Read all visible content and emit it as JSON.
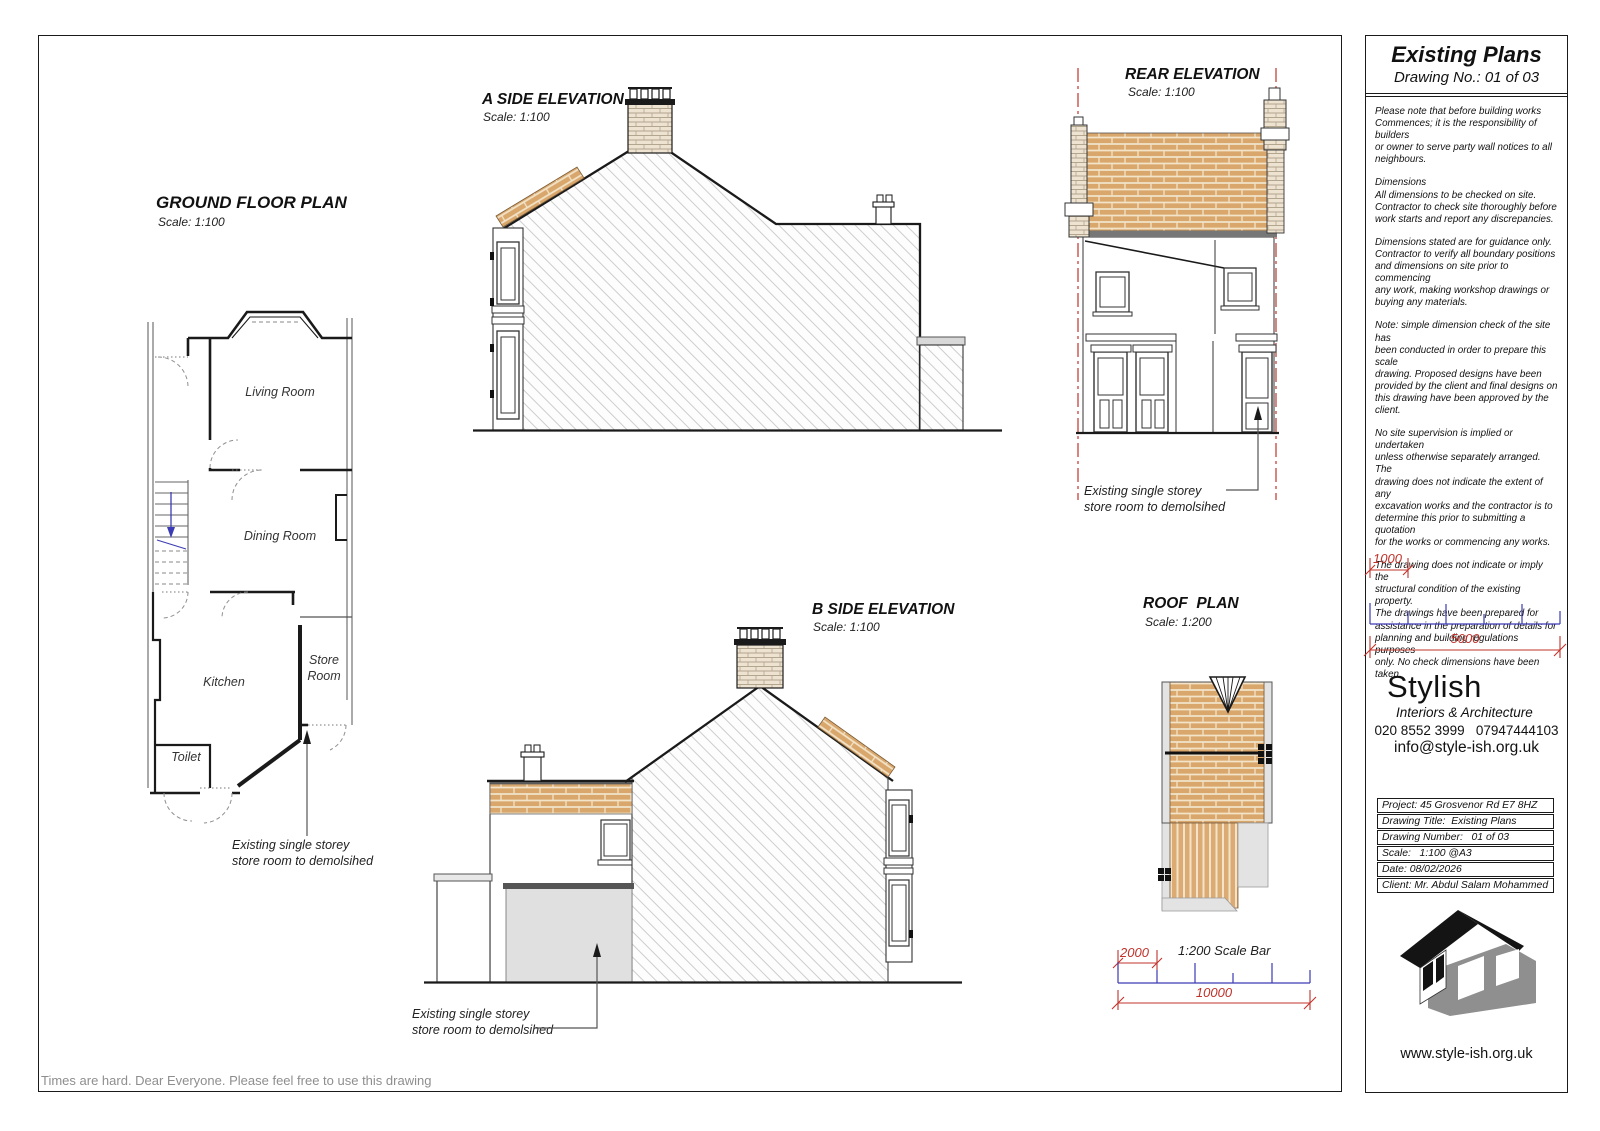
{
  "page": {
    "footer_note": "Times are hard. Dear Everyone. Please feel free to use this drawing"
  },
  "drawings": {
    "ground_floor_plan": {
      "title": "GROUND FLOOR PLAN",
      "scale": "Scale: 1:100",
      "rooms": {
        "living": "Living Room",
        "dining": "Dining Room",
        "kitchen": "Kitchen",
        "store_line1": "Store",
        "store_line2": "Room",
        "toilet": "Toilet"
      },
      "annotation": {
        "line1": "Existing single storey",
        "line2": "store room to demolsihed"
      }
    },
    "a_side_elevation": {
      "title": "A SIDE ELEVATION",
      "scale": "Scale: 1:100"
    },
    "b_side_elevation": {
      "title": "B SIDE ELEVATION",
      "scale": "Scale: 1:100",
      "annotation": {
        "line1": "Existing single storey",
        "line2": "store room to demolsihed"
      }
    },
    "rear_elevation": {
      "title": "REAR ELEVATION",
      "scale": "Scale: 1:100",
      "annotation": {
        "line1": "Existing single storey",
        "line2": "store room to demolsihed"
      }
    },
    "roof_plan": {
      "title": "ROOF  PLAN",
      "scale": "Scale: 1:200"
    },
    "scale_bar_200": {
      "small": "2000",
      "label": "1:200 Scale Bar",
      "large": "10000"
    }
  },
  "panel": {
    "title": "Existing Plans",
    "drawing_no": "Drawing No.: 01 of 03",
    "notes": [
      "Please note that before building works\nCommences; it is the responsibility of builders\nor owner to serve party wall notices to all\nneighbours.",
      "Dimensions\nAll dimensions to be checked on site.\nContractor to check site thoroughly before\nwork starts and report any discrepancies.",
      "Dimensions stated are for guidance only.\nContractor to verify all boundary positions\nand dimensions on site prior to commencing\nany work, making workshop drawings or\nbuying any materials.",
      "Note: simple dimension check of the site has\nbeen conducted in order to prepare this scale\ndrawing. Proposed designs have been\nprovided by the client and final designs on\nthis drawing have been approved by the client.",
      "No site supervision is implied or undertaken\nunless otherwise separately arranged. The\ndrawing does not indicate the extent of any\nexcavation works and the contractor is to\ndetermine this prior to submitting a quotation\nfor the works or commencing any works.",
      "The drawing does not indicate or imply the\nstructural condition of the existing property.\nThe drawings have been prepared for\nassistance in the preparation of details for\nplanning and building regulations purposes\nonly. No check dimensions have been taken."
    ],
    "scale_bar_100": {
      "small": "1000",
      "large": "5000"
    },
    "brand": {
      "name": "Stylish",
      "tagline": "Interiors & Architecture",
      "phone": "020 8552 3999   07947444103",
      "email": "info@style-ish.org.uk",
      "website": "www.style-ish.org.uk"
    },
    "project_table": {
      "rows": [
        "Project: 45 Grosvenor Rd E7 8HZ",
        "Drawing Title:  Existing Plans",
        "Drawing Number:   01 of 03",
        "Scale:   1:100 @A3",
        "Date: 08/02/2026",
        "Client: Mr. Abdul Salam Mohammed"
      ]
    }
  },
  "colors": {
    "roof_tile": "#d9a76c",
    "tile_joint": "#f2e3c9",
    "chimney_brick": "#ede3d0",
    "dim_red": "#c0332b",
    "tick_blue": "#3b3bb4",
    "hatch_gray": "#cdcdcd"
  }
}
